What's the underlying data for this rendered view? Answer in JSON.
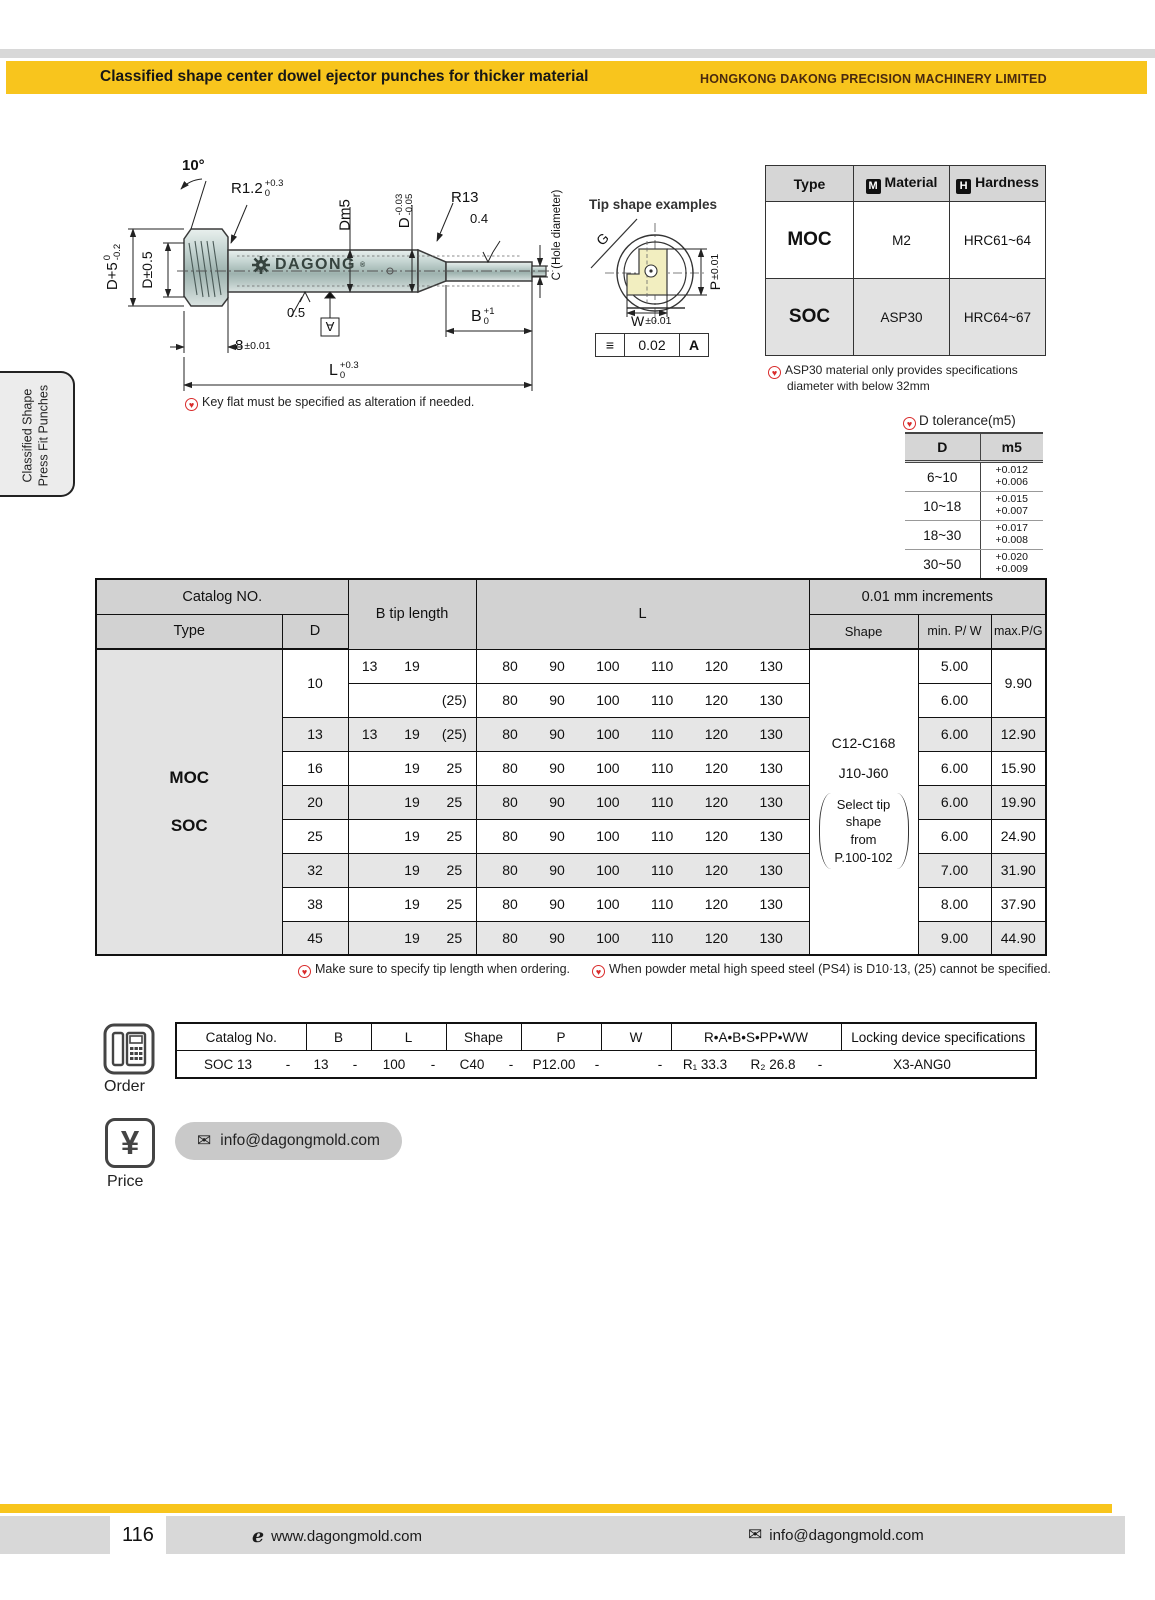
{
  "header": {
    "title": "Classified shape center dowel ejector punches for thicker material",
    "company": "HONGKONG DAKONG PRECISION MACHINERY LIMITED"
  },
  "sidebar": {
    "line1": "Classified Shape",
    "line2": "Press Fit Punches"
  },
  "drawing": {
    "labels": {
      "angle": "10°",
      "r12": {
        "main": "R1.2",
        "sup": "+0.3",
        "sub": "0"
      },
      "dm5": "Dm5",
      "d_tol": {
        "main": "D",
        "sup": "-0.03",
        "sub": "-0.05"
      },
      "r13": "R13",
      "finish_tip": "0.4",
      "c_hole": "C (Hole diameter)",
      "d_plus5": {
        "main": "D+5",
        "sup": "0",
        "sub": "-0.2"
      },
      "d_pm": "D±0.5",
      "eight": {
        "main": "8",
        "tol": "±0.01"
      },
      "finish_body": "0.5",
      "datum": "A",
      "b_tol": {
        "main": "B",
        "sup": "+1",
        "sub": "0"
      },
      "l_tol": {
        "main": "L",
        "sup": "+0.3",
        "sub": "0"
      },
      "brand": "DAGONG",
      "reg": "®"
    },
    "note": "Key flat must be specified as alteration if needed."
  },
  "tip_example": {
    "title": "Tip shape examples",
    "g": "G",
    "p": {
      "main": "P",
      "tol": "±0.01"
    },
    "w": {
      "main": "W",
      "tol": "±0.01"
    },
    "frame": {
      "sym": "≡",
      "value": "0.02",
      "datum": "A"
    }
  },
  "material_table": {
    "h_type": "Type",
    "h_material": "Material",
    "h_hardness": "Hardness",
    "m_icon": "M",
    "h_icon": "H",
    "rows": [
      {
        "type": "MOC",
        "material": "M2",
        "hardness": "HRC61~64"
      },
      {
        "type": "SOC",
        "material": "ASP30",
        "hardness": "HRC64~67"
      }
    ],
    "note1": "ASP30 material only provides specifications",
    "note2": "diameter with below 32mm"
  },
  "tolerance_table": {
    "title": "D tolerance(m5)",
    "col1": "D",
    "col2": "m5",
    "rows": [
      {
        "d": "6~10",
        "hi": "+0.012",
        "lo": "+0.006"
      },
      {
        "d": "10~18",
        "hi": "+0.015",
        "lo": "+0.007"
      },
      {
        "d": "18~30",
        "hi": "+0.017",
        "lo": "+0.008"
      },
      {
        "d": "30~50",
        "hi": "+0.020",
        "lo": "+0.009"
      }
    ]
  },
  "main_table": {
    "h_catalog": "Catalog NO.",
    "h_type": "Type",
    "h_d": "D",
    "h_btip": "B tip length",
    "h_l": "L",
    "h_incr": "0.01 mm increments",
    "h_shape": "Shape",
    "h_min": "min. P/ W",
    "h_max": "max.P/G",
    "type_moc": "MOC",
    "type_soc": "SOC",
    "shape_line1": "C12-C168",
    "shape_line2": "J10-J60",
    "shape_note1": "Select tip",
    "shape_note2": "shape",
    "shape_note3": "from",
    "shape_note4": "P.100-102",
    "rows": [
      {
        "d": "10",
        "b1": "13",
        "b2": "19",
        "b3": "",
        "l": [
          "80",
          "90",
          "100",
          "110",
          "120",
          "130"
        ],
        "min": "5.00",
        "max": "9.90"
      },
      {
        "d": "",
        "b1": "",
        "b2": "",
        "b3": "(25)",
        "l": [
          "80",
          "90",
          "100",
          "110",
          "120",
          "130"
        ],
        "min": "6.00",
        "max": ""
      },
      {
        "d": "13",
        "b1": "13",
        "b2": "19",
        "b3": "(25)",
        "l": [
          "80",
          "90",
          "100",
          "110",
          "120",
          "130"
        ],
        "min": "6.00",
        "max": "12.90"
      },
      {
        "d": "16",
        "b1": "",
        "b2": "19",
        "b3": "25",
        "l": [
          "80",
          "90",
          "100",
          "110",
          "120",
          "130"
        ],
        "min": "6.00",
        "max": "15.90"
      },
      {
        "d": "20",
        "b1": "",
        "b2": "19",
        "b3": "25",
        "l": [
          "80",
          "90",
          "100",
          "110",
          "120",
          "130"
        ],
        "min": "6.00",
        "max": "19.90"
      },
      {
        "d": "25",
        "b1": "",
        "b2": "19",
        "b3": "25",
        "l": [
          "80",
          "90",
          "100",
          "110",
          "120",
          "130"
        ],
        "min": "6.00",
        "max": "24.90"
      },
      {
        "d": "32",
        "b1": "",
        "b2": "19",
        "b3": "25",
        "l": [
          "80",
          "90",
          "100",
          "110",
          "120",
          "130"
        ],
        "min": "7.00",
        "max": "31.90"
      },
      {
        "d": "38",
        "b1": "",
        "b2": "19",
        "b3": "25",
        "l": [
          "80",
          "90",
          "100",
          "110",
          "120",
          "130"
        ],
        "min": "8.00",
        "max": "37.90"
      },
      {
        "d": "45",
        "b1": "",
        "b2": "19",
        "b3": "25",
        "l": [
          "80",
          "90",
          "100",
          "110",
          "120",
          "130"
        ],
        "min": "9.00",
        "max": "44.90"
      }
    ],
    "note1": "Make sure to specify tip length when ordering.",
    "note2": "When powder metal high speed steel (PS4) is D10·13, (25) cannot be specified."
  },
  "order": {
    "label": "Order",
    "headers": [
      "Catalog No.",
      "B",
      "L",
      "Shape",
      "P",
      "W",
      "R•A•B•S•PP•WW",
      "Locking device specifications"
    ],
    "values": [
      "SOC 13",
      "-",
      "13",
      "-",
      "100",
      "-",
      "C40",
      "-",
      "P12.00",
      "-",
      "",
      "-",
      "R₁ 33.3",
      "R₂ 26.8",
      "-",
      "X3-ANG0"
    ]
  },
  "price": {
    "label": "Price",
    "email": "info@dagongmold.com"
  },
  "footer": {
    "page": "116",
    "web": "www.dagongmold.com",
    "email": "info@dagongmold.com"
  }
}
